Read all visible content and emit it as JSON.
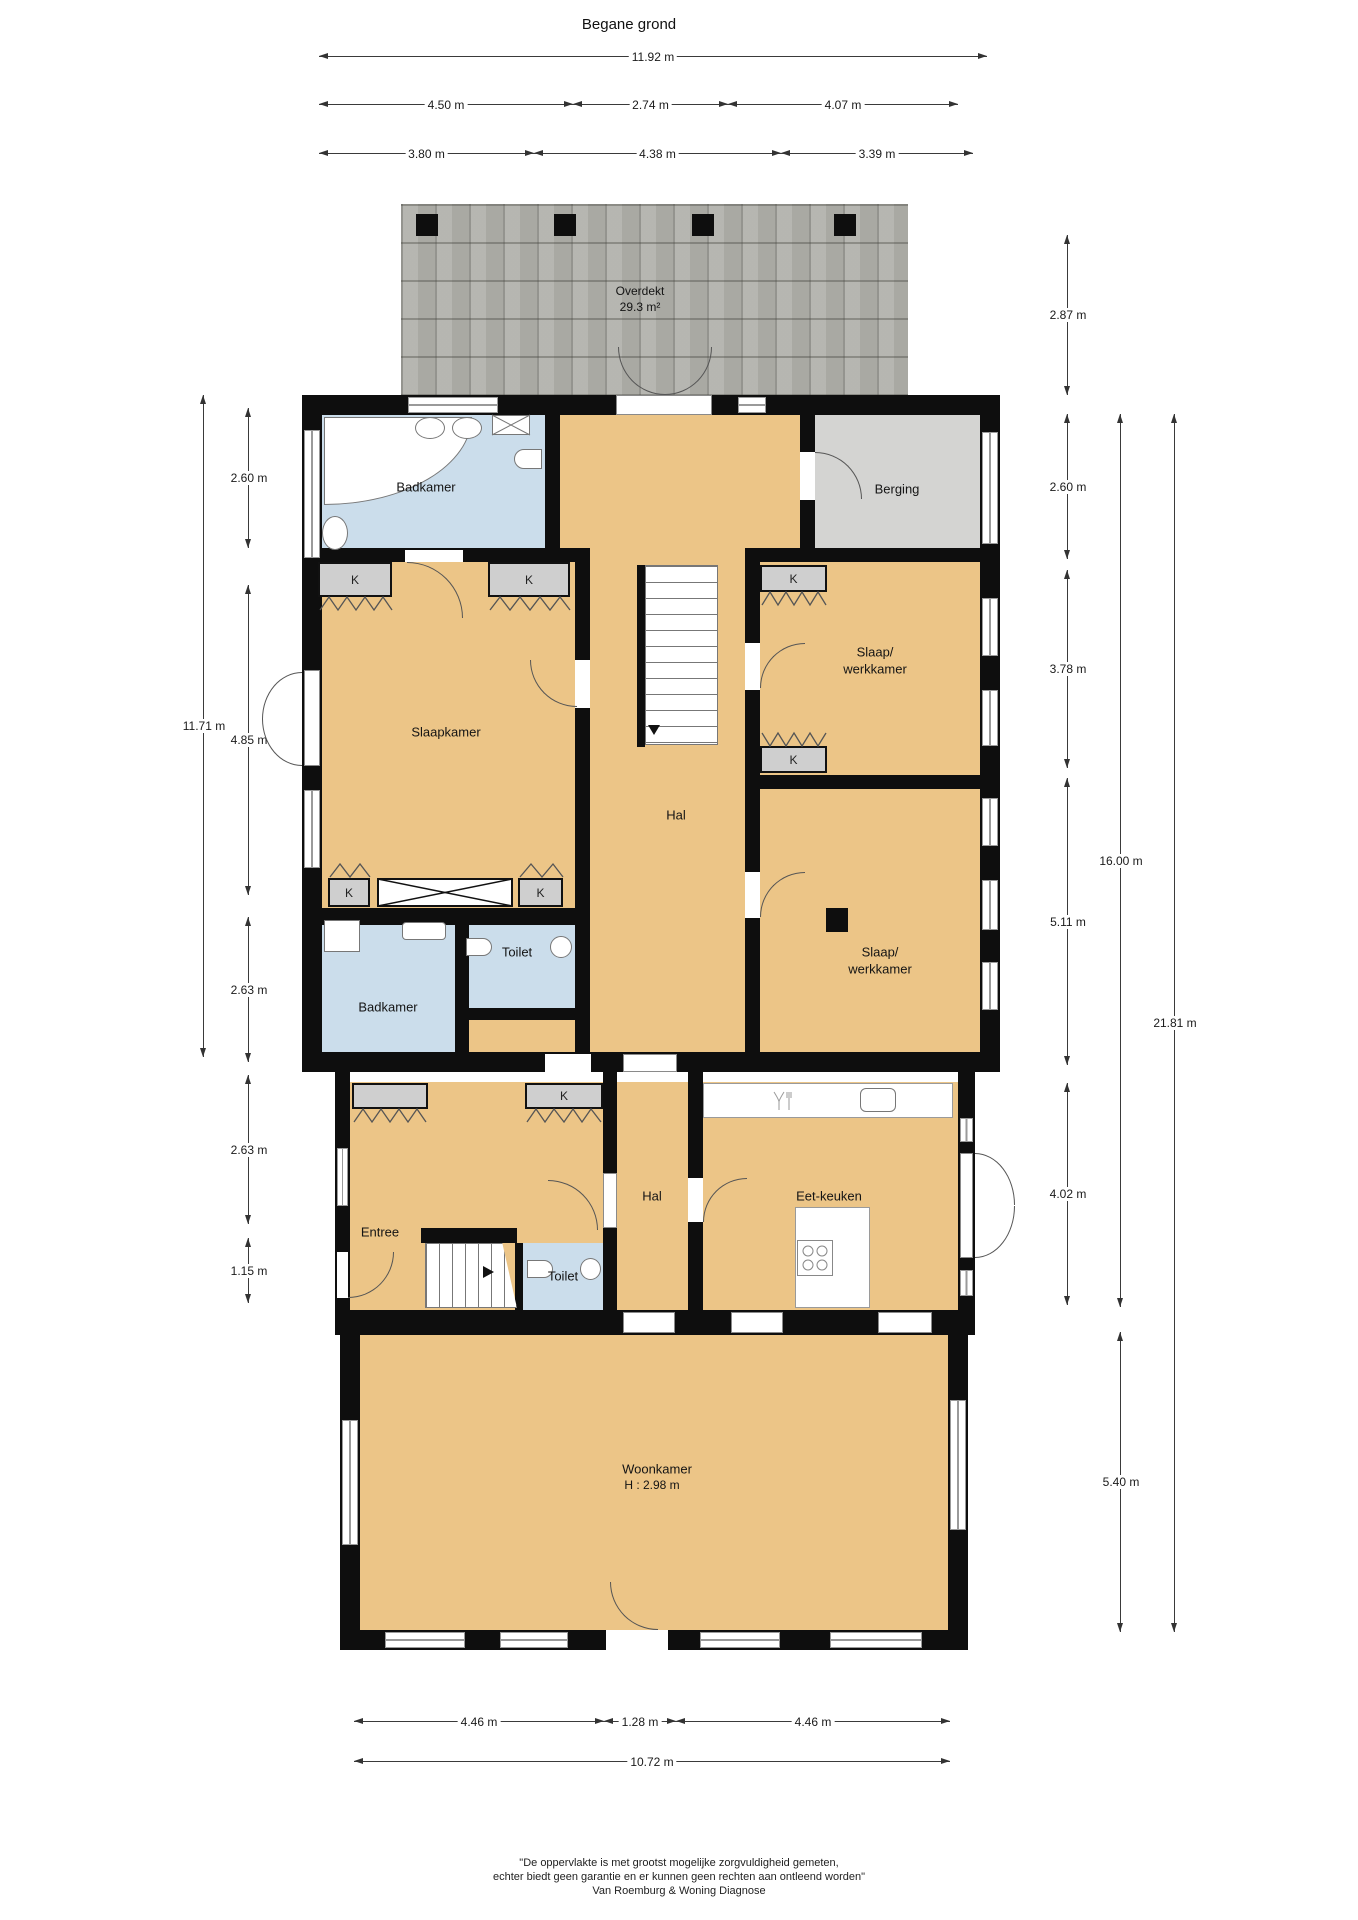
{
  "title": "Begane grond",
  "roof": {
    "name": "Overdekt",
    "area": "29.3 m²"
  },
  "closet": "K",
  "rooms": {
    "badkamer1": "Badkamer",
    "berging": "Berging",
    "slaapkamer": "Slaapkamer",
    "hal1": "Hal",
    "slaapwerkkamer1": [
      "Slaap/",
      "werkkamer"
    ],
    "slaapwerkkamer2": [
      "Slaap/",
      "werkkamer"
    ],
    "badkamer2": "Badkamer",
    "toilet1": "Toilet",
    "entree": "Entree",
    "hal2": "Hal",
    "toilet2": "Toilet",
    "eetkeuken": "Eet-keuken",
    "woonkamer": "Woonkamer",
    "woonkamer_height": "H : 2.98 m"
  },
  "dims": {
    "top_total": "11.92 m",
    "top_row2": [
      "4.50 m",
      "2.74 m",
      "4.07 m"
    ],
    "top_row3": [
      "3.80 m",
      "4.38 m",
      "3.39 m"
    ],
    "left": [
      "2.60 m",
      "11.71 m",
      "4.85 m",
      "2.63 m",
      "2.63 m",
      "1.15 m"
    ],
    "right": [
      "2.87 m",
      "2.60 m",
      "3.78 m",
      "5.11 m",
      "4.02 m",
      "16.00 m",
      "5.40 m",
      "21.81 m"
    ],
    "bottom_row1": [
      "4.46 m",
      "1.28 m",
      "4.46 m"
    ],
    "bottom_total": "10.72 m"
  },
  "footer": [
    "\"De oppervlakte is met grootst mogelijke zorgvuldigheid gemeten,",
    "echter biedt geen garantie en er kunnen geen rechten aan ontleend worden\"",
    "Van Roemburg & Woning Diagnose"
  ]
}
